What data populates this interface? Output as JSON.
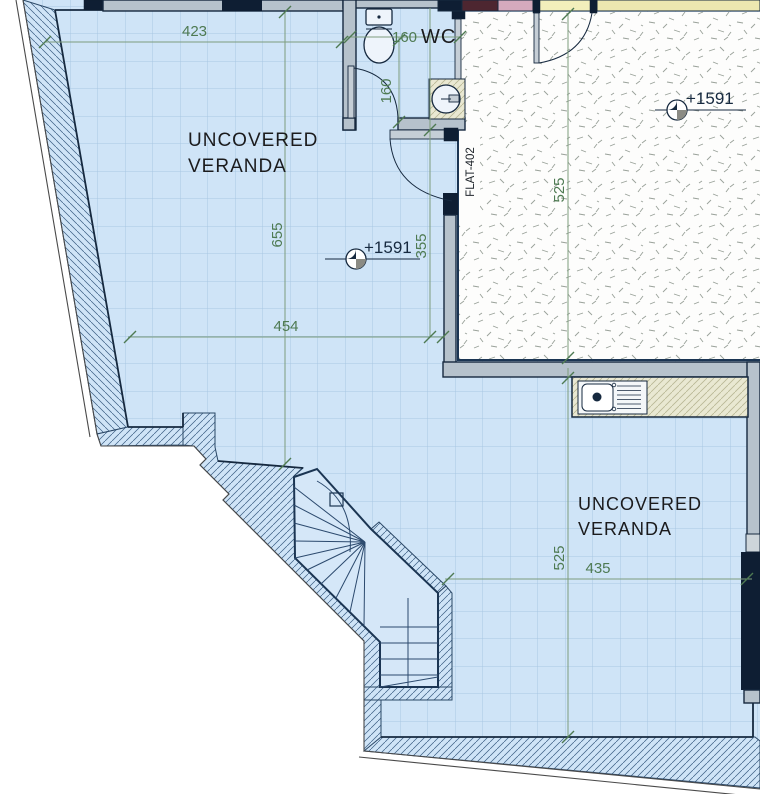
{
  "drawing": {
    "rooms": {
      "veranda_upper": {
        "line1": "UNCOVERED",
        "line2": "VERANDA"
      },
      "veranda_lower": {
        "line1": "UNCOVERED",
        "line2": "VERANDA"
      },
      "wc": "WC",
      "flat": "FLAT-402"
    },
    "levels": {
      "flat": "+1591",
      "veranda": "+1591"
    },
    "dimensions": {
      "top_width": "423",
      "wc_width": "160",
      "wc_depth": "160",
      "veranda_height": "655",
      "veranda_mid": "355",
      "veranda_width": "454",
      "flat_depth": "525",
      "lower_depth": "525",
      "lower_width": "435"
    },
    "colors": {
      "veranda_blue": "#cfe4f7",
      "grid_blue": "#a9c7e3",
      "outline_navy": "#16293f",
      "wall_gray": "#b6c2cc",
      "column_navy": "#0e1e33",
      "dim_green": "#4e7a52",
      "band_maroon": "#4d2630",
      "band_pink": "#d5aabd",
      "band_yellow": "#f3efbb",
      "band_khaki": "#ece7b0",
      "counter_beige": "#e9e8d2",
      "marker_gray": "#8b8b84"
    }
  }
}
